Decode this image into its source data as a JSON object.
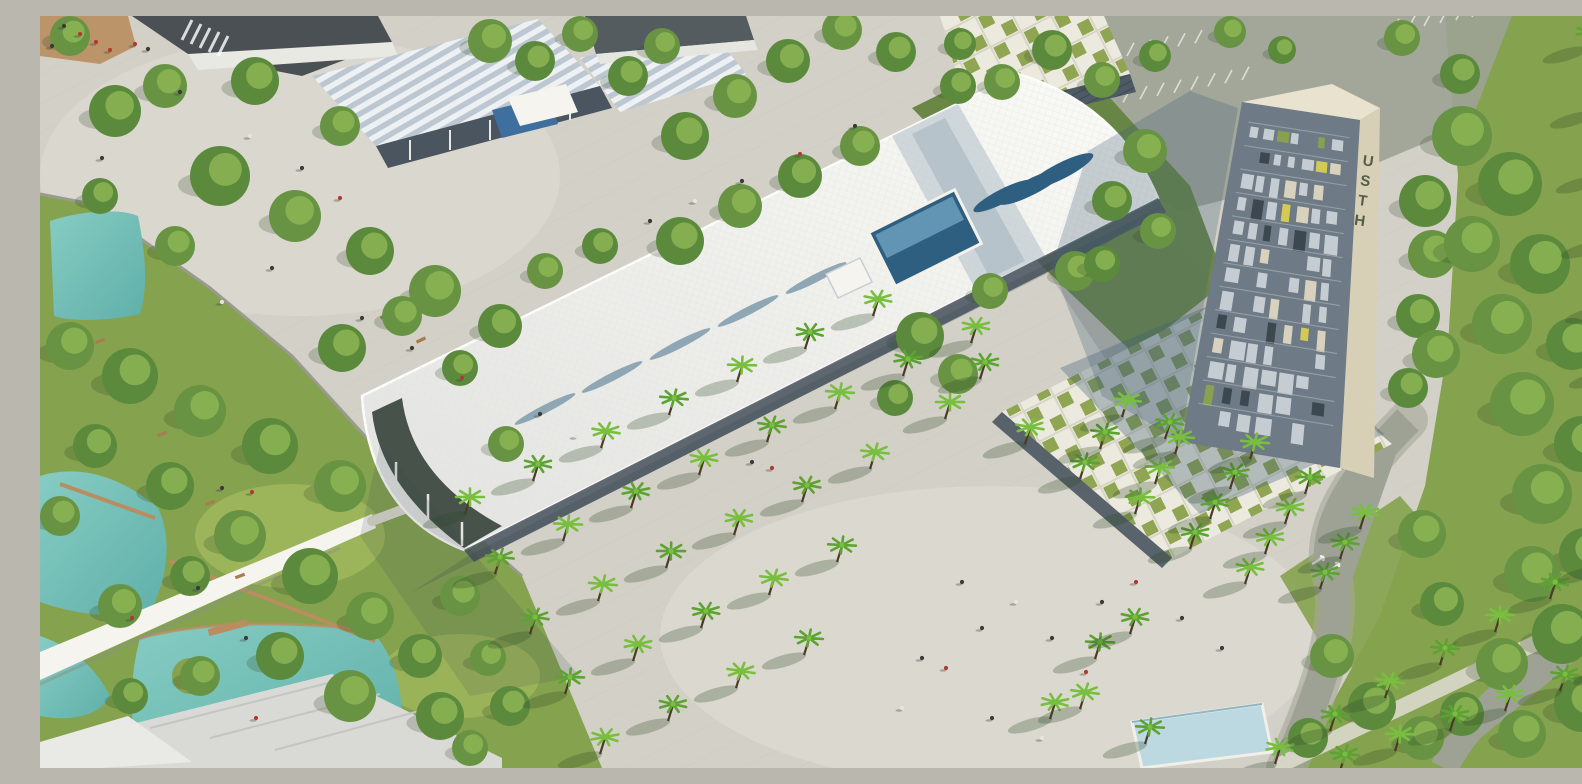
{
  "meta": {
    "scene_description": "Aerial architectural rendering of a green campus: long white curved-roof building with lens skylights and glass atrium, cream office tower with vertical USTH signage, checkered grass-roof pavilions, palm-tree plaza, lawns, turquoise ponds with wooden jetties, pedestrian bridge, parking lot and curving roads"
  },
  "signage": {
    "tower_text": "USTH"
  },
  "palette": {
    "pavement": "#d2d0c7",
    "pavement_light": "#e2e0d6",
    "pavement_shadow": "#b8b7ae",
    "asphalt": "#9da295",
    "road": "#a6a79a",
    "path_light": "#dcd9cc",
    "grass": "#85a24e",
    "grass_light": "#a3ba5e",
    "grass_dark": "#64833f",
    "tree_green": "#679343",
    "tree_green2": "#5c8a3d",
    "tree_light": "#92ba55",
    "tree_shadow": "#2e4626",
    "palm_green": "#5da332",
    "palm_light": "#79bf3f",
    "trunk": "#4d3a26",
    "water": "#6fbdb5",
    "water_light": "#9bd3ca",
    "pool": "#bcd9e2",
    "roof_white": "#f5f4ef",
    "roof_shade": "#c2cdd4",
    "skylight_blue": "#2f5f80",
    "skylight_light": "#6fa3c0",
    "glass_dark": "#4a5560",
    "stripe_roof": "#bcc7d1",
    "stripe_roof_light": "#eef1f3",
    "tower_cream": "#d8d0b6",
    "tower_cream_light": "#e8e2cf",
    "tower_facade": "#6e7a85",
    "window_light": "#c9d1d6",
    "window_dark": "#3a444d",
    "wood": "#b98d5f",
    "bench": "#a97c4f",
    "people_red": "#b03a2e",
    "people_dark": "#3a3a3a",
    "people_light": "#e8e4da",
    "shadow": "#32404c"
  },
  "scene": {
    "palms": [
      [
        425,
        495
      ],
      [
        493,
        462
      ],
      [
        561,
        429
      ],
      [
        629,
        396
      ],
      [
        697,
        363
      ],
      [
        765,
        330
      ],
      [
        833,
        297
      ],
      [
        455,
        555
      ],
      [
        523,
        522
      ],
      [
        591,
        489
      ],
      [
        659,
        456
      ],
      [
        727,
        423
      ],
      [
        795,
        390
      ],
      [
        863,
        357
      ],
      [
        931,
        324
      ],
      [
        490,
        615
      ],
      [
        558,
        582
      ],
      [
        626,
        549
      ],
      [
        694,
        516
      ],
      [
        762,
        483
      ],
      [
        830,
        450
      ],
      [
        525,
        675
      ],
      [
        593,
        642
      ],
      [
        661,
        609
      ],
      [
        729,
        576
      ],
      [
        797,
        543
      ],
      [
        560,
        735
      ],
      [
        628,
        702
      ],
      [
        696,
        669
      ],
      [
        764,
        636
      ],
      [
        905,
        400
      ],
      [
        940,
        360
      ],
      [
        985,
        425
      ],
      [
        1040,
        460
      ],
      [
        1095,
        495
      ],
      [
        1150,
        530
      ],
      [
        1205,
        565
      ],
      [
        1060,
        430
      ],
      [
        1115,
        465
      ],
      [
        1170,
        500
      ],
      [
        1225,
        535
      ],
      [
        1280,
        570
      ],
      [
        1135,
        435
      ],
      [
        1190,
        470
      ],
      [
        1245,
        505
      ],
      [
        1300,
        540
      ],
      [
        1210,
        440
      ],
      [
        1265,
        475
      ],
      [
        1320,
        510
      ],
      [
        1125,
        420
      ],
      [
        1082,
        398
      ],
      [
        1055,
        640
      ],
      [
        1010,
        700
      ],
      [
        1090,
        615
      ],
      [
        1040,
        690
      ],
      [
        1105,
        725
      ],
      [
        1235,
        745
      ],
      [
        1290,
        712
      ],
      [
        1345,
        679
      ],
      [
        1400,
        646
      ],
      [
        1455,
        613
      ],
      [
        1510,
        580
      ],
      [
        1560,
        550
      ],
      [
        1300,
        752
      ],
      [
        1355,
        732
      ],
      [
        1410,
        712
      ],
      [
        1465,
        692
      ],
      [
        1520,
        672
      ],
      [
        1575,
        652
      ],
      [
        1545,
        30
      ],
      [
        1552,
        95
      ],
      [
        1558,
        160
      ],
      [
        1563,
        225
      ],
      [
        1567,
        290
      ],
      [
        1571,
        355
      ]
    ],
    "trees": [
      [
        75,
        95,
        26
      ],
      [
        125,
        70,
        22
      ],
      [
        215,
        65,
        24
      ],
      [
        300,
        110,
        20
      ],
      [
        180,
        160,
        30
      ],
      [
        255,
        200,
        26
      ],
      [
        330,
        235,
        24
      ],
      [
        395,
        275,
        26
      ],
      [
        460,
        310,
        22
      ],
      [
        135,
        230,
        20
      ],
      [
        60,
        180,
        18
      ],
      [
        30,
        20,
        20
      ],
      [
        640,
        225,
        24
      ],
      [
        700,
        190,
        22
      ],
      [
        760,
        160,
        22
      ],
      [
        820,
        130,
        20
      ],
      [
        645,
        120,
        24
      ],
      [
        695,
        80,
        22
      ],
      [
        748,
        45,
        22
      ],
      [
        802,
        14,
        20
      ],
      [
        856,
        36,
        20
      ],
      [
        505,
        255,
        18
      ],
      [
        560,
        230,
        18
      ],
      [
        450,
        25,
        22
      ],
      [
        495,
        45,
        20
      ],
      [
        540,
        18,
        18
      ],
      [
        588,
        60,
        20
      ],
      [
        622,
        30,
        18
      ],
      [
        920,
        28,
        16
      ],
      [
        962,
        66,
        18
      ],
      [
        1012,
        34,
        20
      ],
      [
        1062,
        64,
        18
      ],
      [
        1115,
        40,
        16
      ],
      [
        1190,
        16,
        16
      ],
      [
        1242,
        34,
        14
      ],
      [
        1362,
        22,
        18
      ],
      [
        1420,
        58,
        20
      ],
      [
        1105,
        135,
        22
      ],
      [
        1072,
        185,
        20
      ],
      [
        1118,
        215,
        18
      ],
      [
        918,
        70,
        18
      ],
      [
        1035,
        255,
        20
      ],
      [
        1062,
        248,
        18
      ],
      [
        950,
        275,
        18
      ],
      [
        1385,
        185,
        26
      ],
      [
        1392,
        238,
        24
      ],
      [
        1378,
        300,
        22
      ],
      [
        1396,
        338,
        24
      ],
      [
        1368,
        372,
        20
      ],
      [
        1422,
        120,
        30
      ],
      [
        1470,
        168,
        32
      ],
      [
        1432,
        228,
        28
      ],
      [
        1500,
        248,
        30
      ],
      [
        1462,
        308,
        30
      ],
      [
        1532,
        328,
        26
      ],
      [
        1482,
        388,
        32
      ],
      [
        1542,
        428,
        28
      ],
      [
        1502,
        478,
        30
      ],
      [
        1545,
        538,
        26
      ],
      [
        1492,
        558,
        28
      ],
      [
        1522,
        618,
        30
      ],
      [
        1462,
        648,
        26
      ],
      [
        1542,
        688,
        28
      ],
      [
        1482,
        718,
        24
      ],
      [
        1422,
        698,
        22
      ],
      [
        1382,
        518,
        24
      ],
      [
        1402,
        588,
        22
      ],
      [
        30,
        330,
        24
      ],
      [
        90,
        360,
        28
      ],
      [
        160,
        395,
        26
      ],
      [
        230,
        430,
        28
      ],
      [
        300,
        470,
        26
      ],
      [
        55,
        430,
        22
      ],
      [
        20,
        500,
        20
      ],
      [
        130,
        470,
        24
      ],
      [
        200,
        520,
        26
      ],
      [
        270,
        560,
        28
      ],
      [
        330,
        600,
        24
      ],
      [
        150,
        560,
        20
      ],
      [
        80,
        590,
        22
      ],
      [
        240,
        640,
        24
      ],
      [
        310,
        680,
        26
      ],
      [
        380,
        640,
        22
      ],
      [
        420,
        580,
        20
      ],
      [
        400,
        700,
        24
      ],
      [
        160,
        660,
        20
      ],
      [
        90,
        680,
        18
      ],
      [
        448,
        642,
        18
      ],
      [
        470,
        690,
        20
      ],
      [
        430,
        732,
        18
      ],
      [
        302,
        332,
        24
      ],
      [
        362,
        300,
        20
      ],
      [
        420,
        352,
        18
      ],
      [
        466,
        428,
        18
      ],
      [
        880,
        320,
        24
      ],
      [
        918,
        358,
        20
      ],
      [
        855,
        382,
        18
      ],
      [
        1292,
        640,
        22
      ],
      [
        1332,
        690,
        24
      ],
      [
        1382,
        722,
        22
      ],
      [
        1268,
        722,
        20
      ]
    ],
    "people": [
      [
        95,
        28,
        1
      ],
      [
        108,
        33,
        0
      ],
      [
        140,
        76,
        0
      ],
      [
        210,
        120,
        2
      ],
      [
        262,
        152,
        0
      ],
      [
        300,
        182,
        1
      ],
      [
        232,
        252,
        0
      ],
      [
        182,
        286,
        2
      ],
      [
        322,
        302,
        0
      ],
      [
        372,
        332,
        0
      ],
      [
        422,
        362,
        1
      ],
      [
        62,
        142,
        0
      ],
      [
        610,
        205,
        0
      ],
      [
        655,
        185,
        2
      ],
      [
        702,
        165,
        0
      ],
      [
        760,
        138,
        1
      ],
      [
        815,
        110,
        0
      ],
      [
        712,
        446,
        0
      ],
      [
        732,
        452,
        1
      ],
      [
        500,
        398,
        0
      ],
      [
        536,
        420,
        2
      ],
      [
        882,
        642,
        0
      ],
      [
        906,
        652,
        1
      ],
      [
        942,
        612,
        0
      ],
      [
        976,
        586,
        2
      ],
      [
        1012,
        622,
        0
      ],
      [
        1046,
        656,
        1
      ],
      [
        952,
        702,
        0
      ],
      [
        1002,
        722,
        2
      ],
      [
        1062,
        586,
        0
      ],
      [
        1096,
        566,
        1
      ],
      [
        922,
        566,
        0
      ],
      [
        862,
        692,
        2
      ],
      [
        1142,
        602,
        0
      ],
      [
        1182,
        632,
        0
      ],
      [
        92,
        602,
        1
      ],
      [
        158,
        572,
        0
      ],
      [
        216,
        702,
        1
      ],
      [
        206,
        622,
        0
      ],
      [
        182,
        472,
        0
      ],
      [
        212,
        476,
        1
      ],
      [
        40,
        18,
        1
      ],
      [
        56,
        26,
        1
      ],
      [
        24,
        10,
        0
      ],
      [
        70,
        34,
        1
      ],
      [
        12,
        30,
        0
      ]
    ],
    "benches": [
      [
        60,
        325,
        -20
      ],
      [
        122,
        418,
        -20
      ],
      [
        250,
        445,
        -20
      ],
      [
        170,
        487,
        -20
      ],
      [
        345,
        300,
        -25
      ],
      [
        363,
        312,
        -25
      ],
      [
        381,
        324,
        -25
      ],
      [
        200,
        560,
        -20
      ],
      [
        298,
        455,
        20
      ]
    ],
    "parking_rows": [
      [
        1005,
        10,
        17,
        -3.2,
        22
      ],
      [
        1032,
        96,
        17,
        -3.2,
        11
      ],
      [
        1352,
        16,
        16,
        -3,
        9
      ],
      [
        1002,
        56,
        17,
        -3.2,
        10
      ]
    ],
    "tower_windows": {
      "quad": [
        [
          1208,
          96
        ],
        [
          1312,
          112
        ],
        [
          1294,
          444
        ],
        [
          1150,
          420
        ]
      ],
      "rows": 13,
      "cols": 7,
      "seed": 7
    }
  }
}
